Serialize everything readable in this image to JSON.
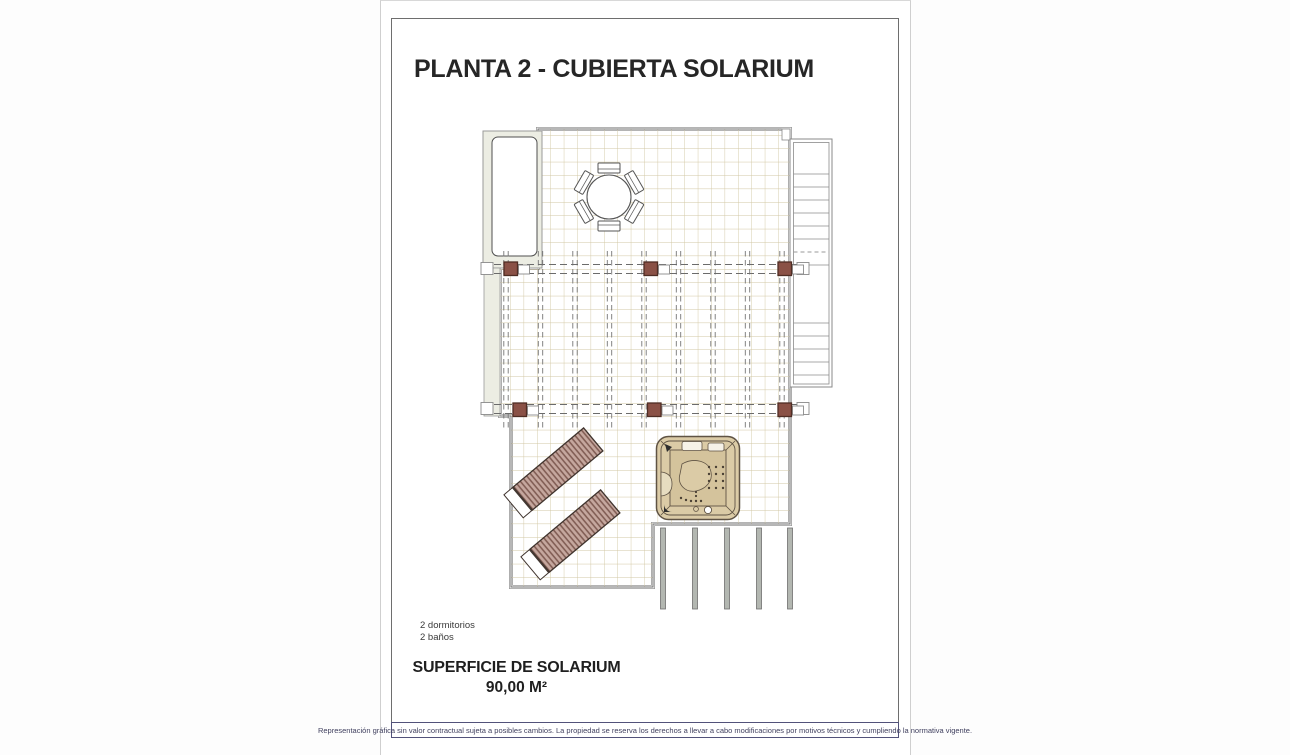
{
  "page": {
    "title": "PLANTA 2 - CUBIERTA SOLARIUM",
    "annotations": [
      "2 dormitorios",
      "2 baños"
    ],
    "area": {
      "label": "SUPERFICIE DE SOLARIUM",
      "value": "90,00 M²"
    },
    "disclaimer": "Representación gráfica sin valor contractual sujeta a posibles cambios. La propiedad se reserva los derechos a llevar a cabo modificaciones por motivos técnicos y cumpliendo la normativa vigente.",
    "colors": {
      "tile_grid": "#d2c7a3",
      "outline": "#6f6f6f",
      "pergola_post": "#8a5146",
      "pergola_post_border": "#4f2d24",
      "lounger_fill": "#c5a79e",
      "lounger_stripe": "#7e5a51",
      "jacuzzi_fill": "#dbcba6",
      "porch_post": "#b3b7b1",
      "disclaimer_border": "#52527a",
      "disclaimer_text": "#40405f"
    },
    "plan_elements": [
      "tiled solarium terrace",
      "pergola with six posts",
      "round dining table with six chairs",
      "two sun loungers",
      "jacuzzi hot tub",
      "staircase",
      "skylight void",
      "lower porch columns"
    ]
  }
}
